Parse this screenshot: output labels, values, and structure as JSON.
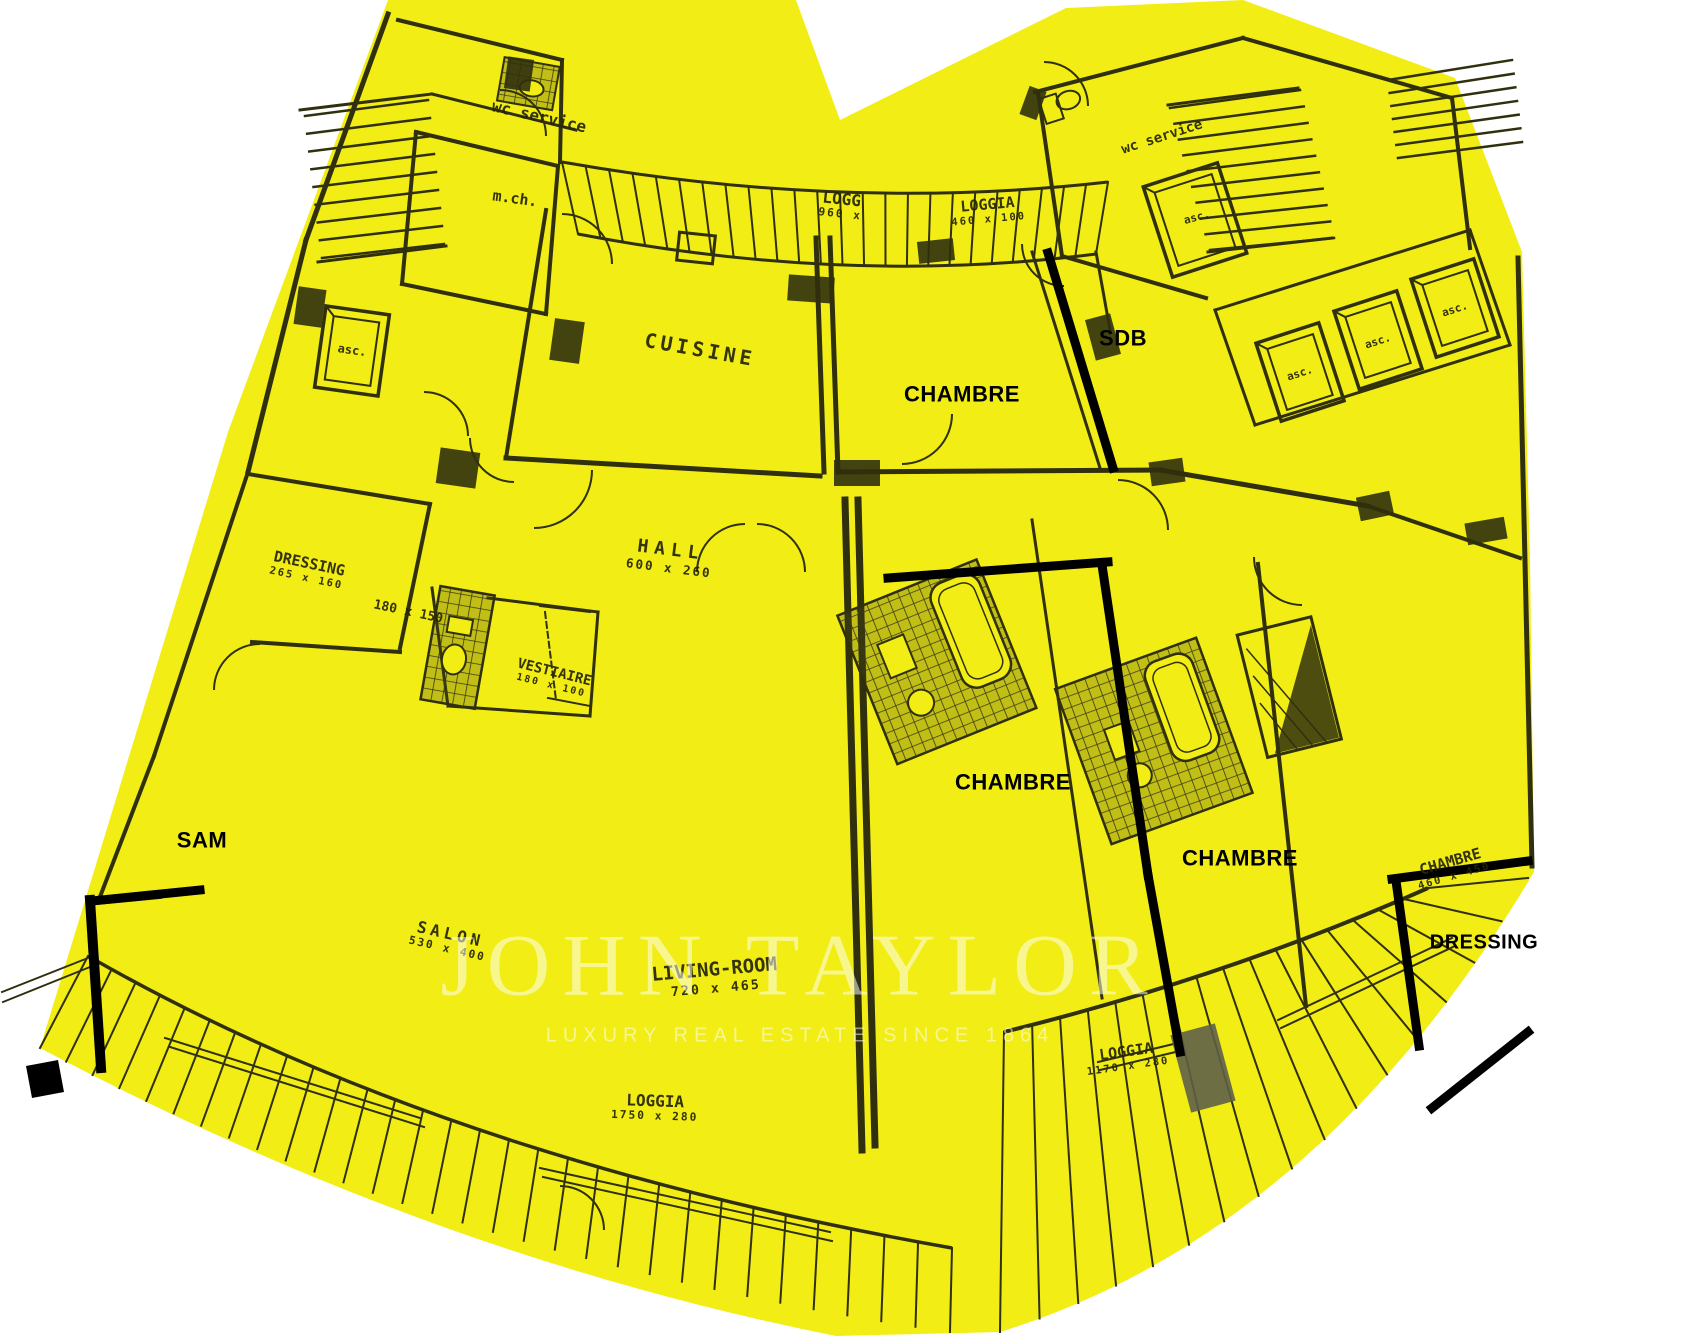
{
  "watermark": {
    "brand": "JOHN TAYLOR",
    "tagline": "LUXURY REAL ESTATE SINCE 1864"
  },
  "colors": {
    "paper": "#f1ed15",
    "ink": "#30300e",
    "annotation": "#000000",
    "shade": "#5f5f49",
    "watermark_text": "#ffffff"
  },
  "labels": [
    {
      "id": "wc-service-left",
      "text": "wc service",
      "x": 539,
      "y": 117,
      "rot": 13,
      "size": 16,
      "style": "plan"
    },
    {
      "id": "m-ch",
      "text": "m.ch.",
      "x": 515,
      "y": 199,
      "rot": 8,
      "size": 15,
      "style": "plan"
    },
    {
      "id": "asc-left",
      "text": "asc.",
      "x": 352,
      "y": 351,
      "rot": 8,
      "size": 12,
      "style": "plan"
    },
    {
      "id": "cuisine",
      "text": "CUISINE",
      "x": 700,
      "y": 350,
      "rot": 10,
      "size": 20,
      "style": "plan",
      "spacing": 4
    },
    {
      "id": "loggia-960",
      "text": "LOGG",
      "dims": "960 x",
      "x": 841,
      "y": 206,
      "rot": 6,
      "size": 16,
      "style": "plan"
    },
    {
      "id": "loggia-460",
      "text": "LOGGIA",
      "dims": "460 x 100",
      "x": 988,
      "y": 211,
      "rot": -5,
      "size": 15,
      "style": "plan"
    },
    {
      "id": "chambre-top",
      "text": "CHAMBRE",
      "x": 962,
      "y": 394,
      "rot": 0,
      "size": 22,
      "style": "bold"
    },
    {
      "id": "sdb",
      "text": "SDB",
      "x": 1123,
      "y": 338,
      "rot": 0,
      "size": 22,
      "style": "bold"
    },
    {
      "id": "wc-service-right",
      "text": "wc service",
      "x": 1162,
      "y": 137,
      "rot": -18,
      "size": 14,
      "style": "plan"
    },
    {
      "id": "asc-right-top",
      "text": "asc.",
      "x": 1197,
      "y": 218,
      "rot": -15,
      "size": 11,
      "style": "plan"
    },
    {
      "id": "asc-1",
      "text": "asc.",
      "x": 1300,
      "y": 374,
      "rot": -18,
      "size": 11,
      "style": "plan"
    },
    {
      "id": "asc-2",
      "text": "asc.",
      "x": 1378,
      "y": 342,
      "rot": -18,
      "size": 11,
      "style": "plan"
    },
    {
      "id": "asc-3",
      "text": "asc.",
      "x": 1455,
      "y": 310,
      "rot": -18,
      "size": 11,
      "style": "plan"
    },
    {
      "id": "dressing-left",
      "text": "DRESSING",
      "dims": "265 x 160",
      "x": 308,
      "y": 570,
      "rot": 12,
      "size": 15,
      "style": "plan"
    },
    {
      "id": "dim-180-150",
      "text": "180 x 150",
      "x": 408,
      "y": 613,
      "rot": 12,
      "size": 13,
      "style": "plan"
    },
    {
      "id": "hall",
      "text": "HALL",
      "dims": "600 x 260",
      "x": 670,
      "y": 558,
      "rot": 7,
      "size": 18,
      "style": "plan",
      "spacing": 6
    },
    {
      "id": "vestiaire",
      "text": "VESTIAIRE",
      "dims": "180 x 100",
      "x": 553,
      "y": 678,
      "rot": 14,
      "size": 14,
      "style": "plan"
    },
    {
      "id": "sam",
      "text": "SAM",
      "x": 202,
      "y": 840,
      "rot": 0,
      "size": 22,
      "style": "bold"
    },
    {
      "id": "salon",
      "text": "SALON",
      "dims": "530 x 400",
      "x": 449,
      "y": 941,
      "rot": 13,
      "size": 16,
      "style": "plan",
      "spacing": 4
    },
    {
      "id": "living-room",
      "text": "LIVING-ROOM",
      "dims": "720 x 465",
      "x": 715,
      "y": 978,
      "rot": -5,
      "size": 19,
      "style": "plan"
    },
    {
      "id": "chambre-mid",
      "text": "CHAMBRE",
      "x": 1013,
      "y": 782,
      "rot": 0,
      "size": 22,
      "style": "bold"
    },
    {
      "id": "chambre-right",
      "text": "CHAMBRE",
      "x": 1240,
      "y": 858,
      "rot": 0,
      "size": 22,
      "style": "bold"
    },
    {
      "id": "chambre-460",
      "text": "CHAMBRE",
      "dims": "460 x 450",
      "x": 1452,
      "y": 868,
      "rot": -16,
      "size": 15,
      "style": "plan"
    },
    {
      "id": "dressing-right",
      "text": "DRESSING",
      "x": 1484,
      "y": 943,
      "rot": 0,
      "size": 20,
      "style": "bold"
    },
    {
      "id": "loggia-1170",
      "text": "LOGGIA",
      "dims": "1170 x 280",
      "x": 1127,
      "y": 1058,
      "rot": -8,
      "size": 15,
      "style": "plan"
    },
    {
      "id": "loggia-1750",
      "text": "LOGGIA",
      "dims": "1750 x 280",
      "x": 655,
      "y": 1108,
      "rot": 2,
      "size": 16,
      "style": "plan"
    }
  ]
}
